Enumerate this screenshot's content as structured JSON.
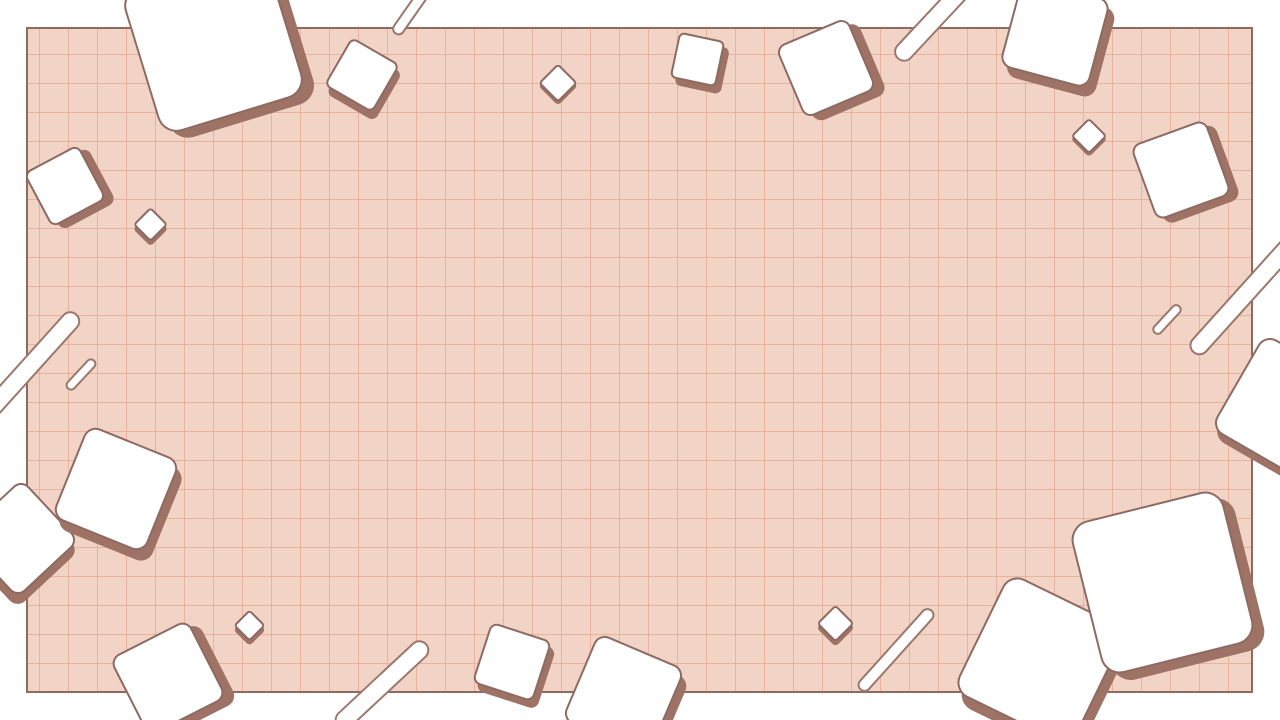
{
  "palette": {
    "page_background": "#ffffff",
    "grid_background": "#f2d4c7",
    "grid_line": "#e9b29c",
    "grid_border": "#8d6a62",
    "shape_fill": "#ffffff",
    "shape_outline": "#8d6a62",
    "stick_outline": "#9c776c",
    "shape_shadow": "#9e7365"
  },
  "grid": {
    "left": 26,
    "top": 27,
    "width": 1227,
    "height": 666,
    "cell_size": 29,
    "border_width": 2
  },
  "decor": {
    "squares": [
      {
        "kind": "square",
        "cx": 213,
        "cy": 42,
        "size": 151,
        "rot": -17,
        "shadow": 9
      },
      {
        "kind": "square",
        "cx": 65,
        "cy": 186,
        "size": 62,
        "rot": -28,
        "shadow": 7
      },
      {
        "kind": "diamond",
        "cx": 150,
        "cy": 224,
        "size": 25,
        "rot": 45,
        "shadow": 3
      },
      {
        "kind": "square",
        "cx": 362,
        "cy": 75,
        "size": 56,
        "rot": 30,
        "shadow": 6
      },
      {
        "kind": "diamond",
        "cx": 558,
        "cy": 83,
        "size": 28,
        "rot": 45,
        "shadow": 2
      },
      {
        "kind": "square",
        "cx": 697,
        "cy": 59,
        "size": 47,
        "rot": 12,
        "shadow": 6
      },
      {
        "kind": "square",
        "cx": 826,
        "cy": 68,
        "size": 78,
        "rot": -23,
        "shadow": 8
      },
      {
        "kind": "square",
        "cx": 1055,
        "cy": 33,
        "size": 92,
        "rot": 15,
        "shadow": 8
      },
      {
        "kind": "diamond",
        "cx": 1089,
        "cy": 136,
        "size": 26,
        "rot": 45,
        "shadow": 2
      },
      {
        "kind": "square",
        "cx": 1181,
        "cy": 170,
        "size": 80,
        "rot": -20,
        "shadow": 7
      },
      {
        "kind": "square",
        "cx": 1285,
        "cy": 408,
        "size": 110,
        "rot": 30,
        "shadow": 6
      },
      {
        "kind": "square",
        "cx": 19,
        "cy": 538,
        "size": 85,
        "rot": 47,
        "shadow": 7
      },
      {
        "kind": "square",
        "cx": 116,
        "cy": 489,
        "size": 100,
        "rot": 22,
        "shadow": 8
      },
      {
        "kind": "square",
        "cx": 168,
        "cy": 678,
        "size": 88,
        "rot": -27,
        "shadow": 8
      },
      {
        "kind": "diamond",
        "cx": 249,
        "cy": 625,
        "size": 23,
        "rot": 45,
        "shadow": 3
      },
      {
        "kind": "square",
        "cx": 512,
        "cy": 662,
        "size": 64,
        "rot": 18,
        "shadow": 6
      },
      {
        "kind": "square",
        "cx": 623,
        "cy": 694,
        "size": 95,
        "rot": 23,
        "shadow": 8
      },
      {
        "kind": "diamond",
        "cx": 835,
        "cy": 623,
        "size": 27,
        "rot": 45,
        "shadow": 3
      },
      {
        "kind": "square",
        "cx": 1040,
        "cy": 660,
        "size": 132,
        "rot": 26,
        "shadow": 9
      },
      {
        "kind": "square",
        "cx": 1162,
        "cy": 582,
        "size": 157,
        "rot": -14,
        "shadow": 9
      }
    ],
    "sticks": [
      {
        "cx": 415,
        "cy": 5,
        "length": 70,
        "thickness": 13,
        "rot": -55
      },
      {
        "cx": 936,
        "cy": 17,
        "length": 115,
        "thickness": 20,
        "rot": -47
      },
      {
        "cx": 20,
        "cy": 377,
        "length": 170,
        "thickness": 20,
        "rot": -48
      },
      {
        "cx": 81,
        "cy": 374,
        "length": 40,
        "thickness": 11,
        "rot": -47
      },
      {
        "cx": 1167,
        "cy": 319,
        "length": 38,
        "thickness": 11,
        "rot": -47
      },
      {
        "cx": 1243,
        "cy": 297,
        "length": 150,
        "thickness": 20,
        "rot": -48
      },
      {
        "cx": 382,
        "cy": 685,
        "length": 122,
        "thickness": 20,
        "rot": -43
      },
      {
        "cx": 896,
        "cy": 650,
        "length": 108,
        "thickness": 14,
        "rot": -48
      }
    ]
  }
}
